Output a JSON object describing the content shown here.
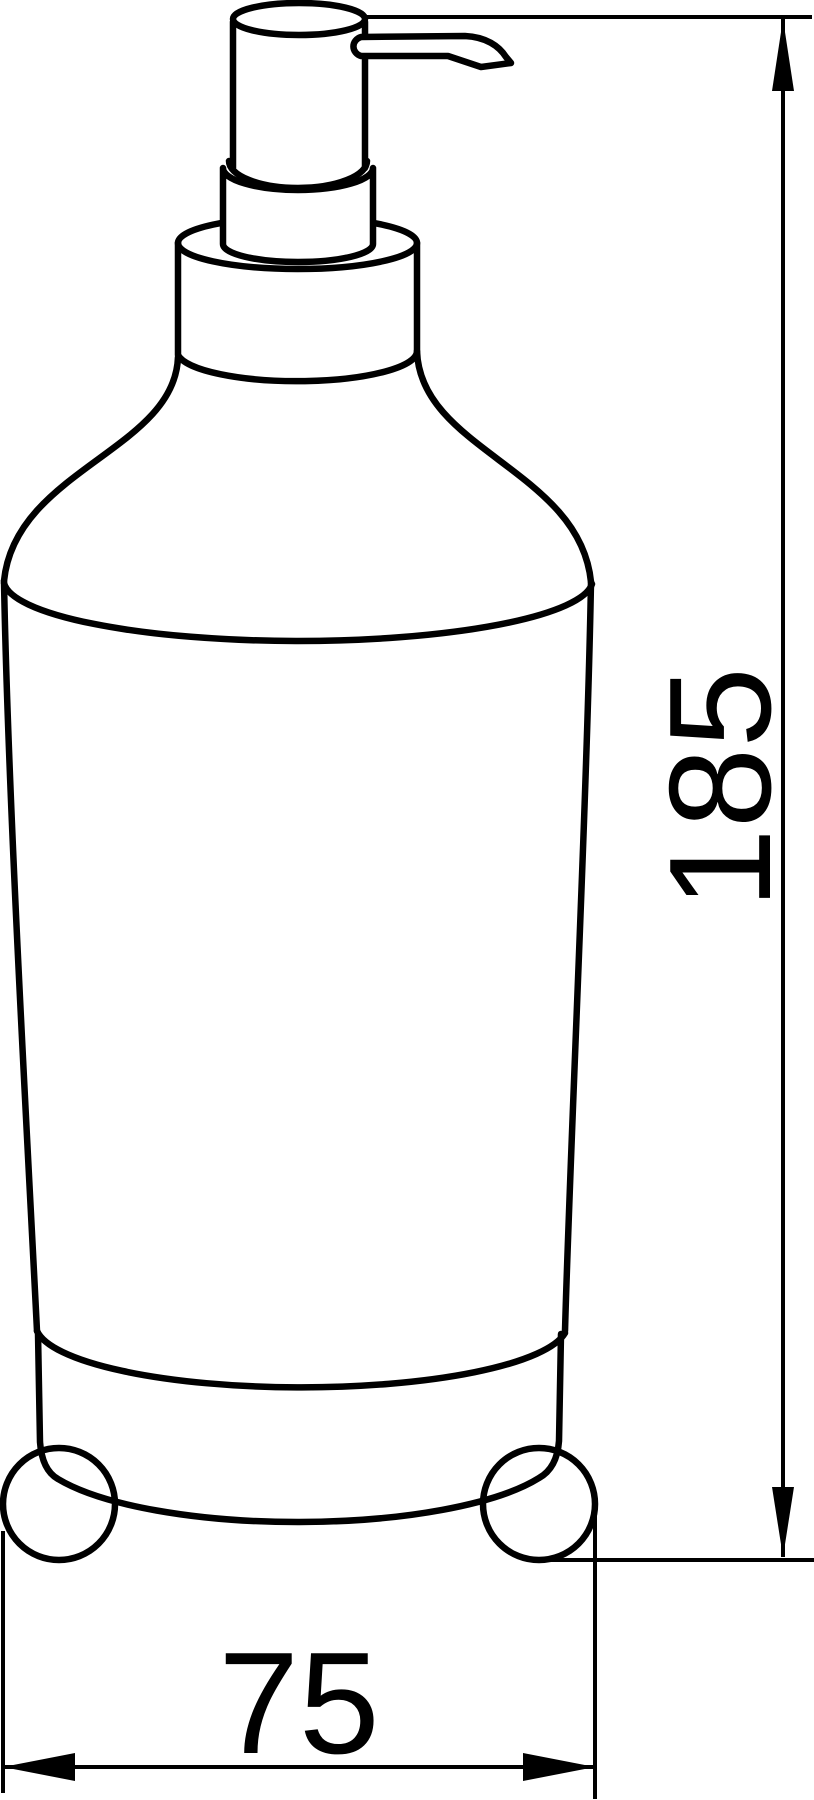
{
  "drawing": {
    "subject": "Soap dispenser with pump top and ball feet, dimensioned side-view technical line drawing",
    "line_color": "#000000",
    "background_color": "#ffffff",
    "dimensions": {
      "height_label": "185",
      "width_label": "75"
    }
  }
}
